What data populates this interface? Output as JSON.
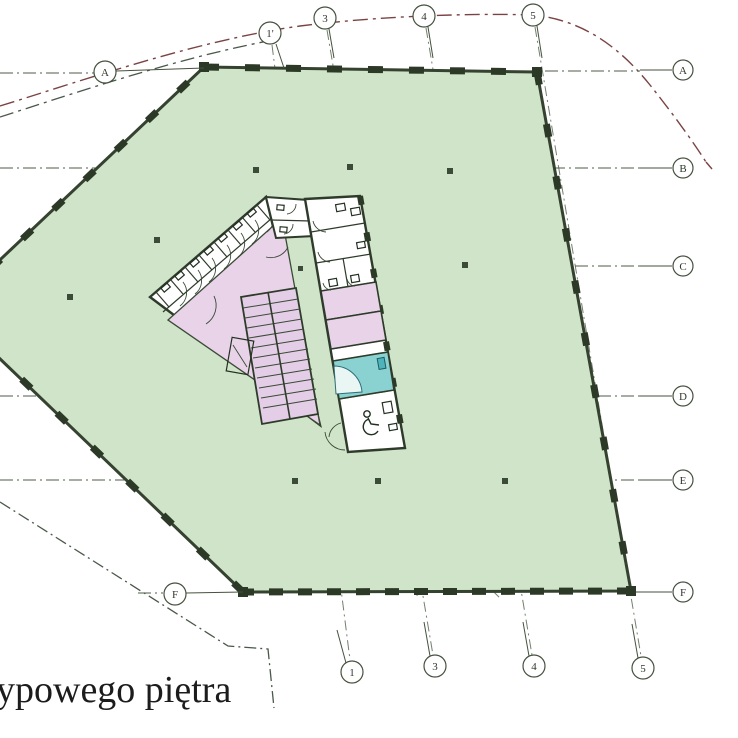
{
  "drawing": {
    "caption": "ypowego piętra",
    "type_note": "architectural floor plan, typical storey"
  },
  "axes": {
    "top": [
      {
        "label": "1'"
      },
      {
        "label": "3"
      },
      {
        "label": "4"
      },
      {
        "label": "5"
      }
    ],
    "bottom": [
      {
        "label": "1"
      },
      {
        "label": "3"
      },
      {
        "label": "4"
      },
      {
        "label": "5"
      }
    ],
    "right": [
      {
        "label": "A"
      },
      {
        "label": "B"
      },
      {
        "label": "C"
      },
      {
        "label": "D"
      },
      {
        "label": "E"
      },
      {
        "label": "F"
      }
    ],
    "left": [
      {
        "label": "A"
      },
      {
        "label": "F"
      }
    ]
  },
  "colors": {
    "floor_green": "#cfe4c8",
    "core_pink": "#e8d3e8",
    "shower_teal": "#8ad1d1",
    "wall_dark": "#2e3b2a",
    "grid_line": "#4e5d48",
    "site_boundary_red": "#7a4343",
    "caption_text": "#1c1c1c"
  }
}
